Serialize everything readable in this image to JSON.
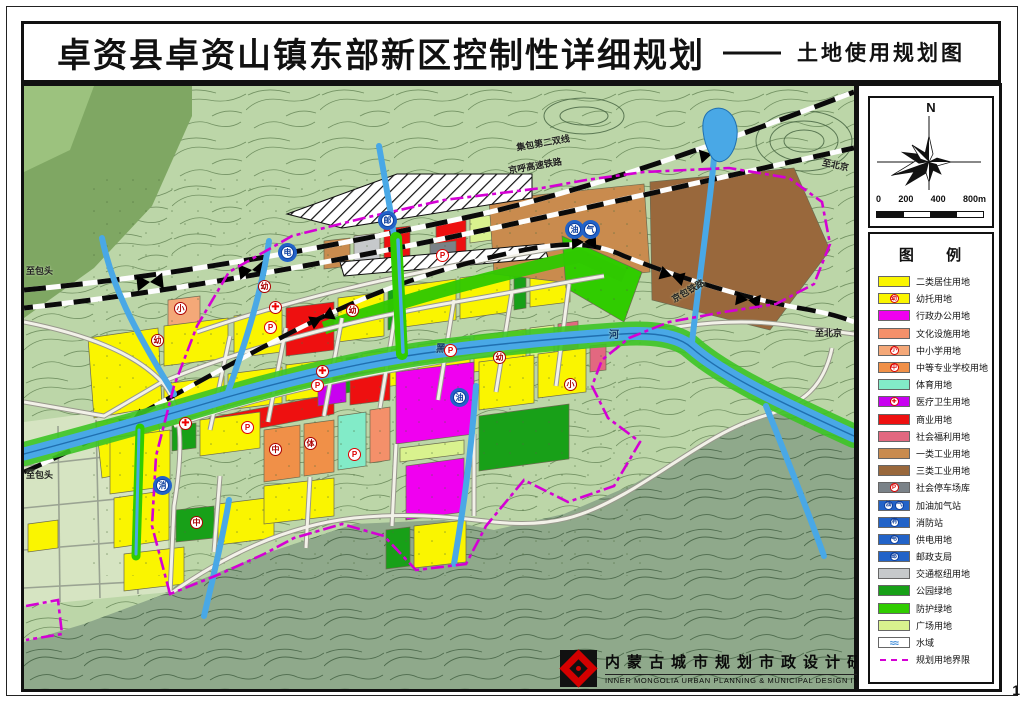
{
  "title": {
    "main": "卓资县卓资山镇东部新区控制性详细规划",
    "dash": "——",
    "sub": "土地使用规划图"
  },
  "compass": {
    "north_label": "N",
    "scale_labels": [
      "0",
      "200",
      "400",
      "800m"
    ]
  },
  "legend": {
    "title": "图 例",
    "items": [
      {
        "label": "二类居住用地",
        "color": "#FAF500",
        "type": "plain"
      },
      {
        "label": "幼托用地",
        "color": "#FAF500",
        "type": "icon",
        "icons": [
          "幼"
        ],
        "icon_style": "red"
      },
      {
        "label": "行政办公用地",
        "color": "#F000F0",
        "type": "plain"
      },
      {
        "label": "文化设施用地",
        "color": "#F4906A",
        "type": "plain"
      },
      {
        "label": "中小学用地",
        "color": "#F4A878",
        "type": "icon",
        "icons": [
          "小"
        ],
        "icon_style": "red"
      },
      {
        "label": "中等专业学校用地",
        "color": "#F09048",
        "type": "icon",
        "icons": [
          "中"
        ],
        "icon_style": "red"
      },
      {
        "label": "体育用地",
        "color": "#82EBC8",
        "type": "plain"
      },
      {
        "label": "医疗卫生用地",
        "color": "#C800F0",
        "type": "icon",
        "icons": [
          "✚"
        ],
        "icon_style": "red"
      },
      {
        "label": "商业用地",
        "color": "#EE1010",
        "type": "plain"
      },
      {
        "label": "社会福利用地",
        "color": "#E26880",
        "type": "plain"
      },
      {
        "label": "一类工业用地",
        "color": "#C98B4E",
        "type": "plain"
      },
      {
        "label": "三类工业用地",
        "color": "#99683C",
        "type": "plain"
      },
      {
        "label": "社会停车场库",
        "color": "#7A8288",
        "type": "icon",
        "icons": [
          "P"
        ],
        "icon_style": "red"
      },
      {
        "label": "加油加气站",
        "color": "#2263C8",
        "type": "icon",
        "icons": [
          "油",
          "气"
        ],
        "icon_style": "blue"
      },
      {
        "label": "消防站",
        "color": "#2263C8",
        "type": "icon",
        "icons": [
          "消"
        ],
        "icon_style": "blue"
      },
      {
        "label": "供电用地",
        "color": "#2263C8",
        "type": "icon",
        "icons": [
          "电"
        ],
        "icon_style": "blue"
      },
      {
        "label": "邮政支局",
        "color": "#2263C8",
        "type": "icon",
        "icons": [
          "邮"
        ],
        "icon_style": "blue"
      },
      {
        "label": "交通枢纽用地",
        "color": "#C6C9CB",
        "type": "plain"
      },
      {
        "label": "公园绿地",
        "color": "#18A018",
        "type": "plain"
      },
      {
        "label": "防护绿地",
        "color": "#30CC00",
        "type": "plain"
      },
      {
        "label": "广场用地",
        "color": "#D9F28E",
        "type": "plain"
      },
      {
        "label": "水域",
        "color": "#FFFFFF",
        "type": "water"
      },
      {
        "label": "规划用地界限",
        "color": "#D400D4",
        "type": "boundary"
      }
    ]
  },
  "map": {
    "labels": [
      {
        "t": "至包头",
        "x": 2,
        "y": 178,
        "s": 9,
        "r": 0
      },
      {
        "t": "至包头",
        "x": 2,
        "y": 382,
        "s": 9,
        "r": 0
      },
      {
        "t": "至北京",
        "x": 798,
        "y": 72,
        "s": 9,
        "r": 12
      },
      {
        "t": "至北京",
        "x": 791,
        "y": 240,
        "s": 9,
        "r": 0
      },
      {
        "t": "集包第二双线",
        "x": 492,
        "y": 50,
        "s": 9,
        "r": -10
      },
      {
        "t": "京呼高速铁路",
        "x": 484,
        "y": 73,
        "s": 9,
        "r": -10
      },
      {
        "t": "京包铁路",
        "x": 646,
        "y": 198,
        "s": 9,
        "r": -30
      },
      {
        "t": "黑",
        "x": 412,
        "y": 254,
        "s": 10,
        "r": 0,
        "c": "#123a6e"
      },
      {
        "t": "河",
        "x": 585,
        "y": 240,
        "s": 10,
        "r": 0,
        "c": "#123a6e"
      }
    ],
    "icons": [
      {
        "k": "edu",
        "g": "幼",
        "x": 133,
        "y": 254
      },
      {
        "k": "edu",
        "g": "幼",
        "x": 240,
        "y": 200
      },
      {
        "k": "edu",
        "g": "幼",
        "x": 328,
        "y": 224
      },
      {
        "k": "edu",
        "g": "幼",
        "x": 475,
        "y": 271
      },
      {
        "k": "edu",
        "g": "小",
        "x": 156,
        "y": 222
      },
      {
        "k": "edu",
        "g": "小",
        "x": 546,
        "y": 298
      },
      {
        "k": "edu",
        "g": "中",
        "x": 251,
        "y": 363
      },
      {
        "k": "edu",
        "g": "中",
        "x": 172,
        "y": 436
      },
      {
        "k": "edu",
        "g": "体",
        "x": 286,
        "y": 357
      },
      {
        "k": "p",
        "g": "P",
        "x": 223,
        "y": 341
      },
      {
        "k": "p",
        "g": "P",
        "x": 246,
        "y": 241
      },
      {
        "k": "p",
        "g": "P",
        "x": 293,
        "y": 299
      },
      {
        "k": "p",
        "g": "P",
        "x": 330,
        "y": 368
      },
      {
        "k": "p",
        "g": "P",
        "x": 418,
        "y": 169
      },
      {
        "k": "p",
        "g": "P",
        "x": 426,
        "y": 264
      },
      {
        "k": "med",
        "g": "✚",
        "x": 298,
        "y": 285
      },
      {
        "k": "med",
        "g": "✚",
        "x": 251,
        "y": 221
      },
      {
        "k": "med",
        "g": "✚",
        "x": 161,
        "y": 337
      },
      {
        "k": "blue",
        "g": "邮",
        "x": 363,
        "y": 134
      },
      {
        "k": "blue",
        "g": "电",
        "x": 263,
        "y": 166
      },
      {
        "k": "blue",
        "g": "油",
        "x": 550,
        "y": 143
      },
      {
        "k": "blue",
        "g": "气",
        "x": 566,
        "y": 143
      },
      {
        "k": "blue",
        "g": "油",
        "x": 435,
        "y": 311
      },
      {
        "k": "blue",
        "g": "消",
        "x": 138,
        "y": 399
      }
    ]
  },
  "footer": {
    "cn": "内蒙古城市规划市政设计研究院",
    "en": "INNER MONGOLIA URBAN PLANNING & MUNICIPAL DESIGN INSTITUTE"
  },
  "page_number": "1"
}
